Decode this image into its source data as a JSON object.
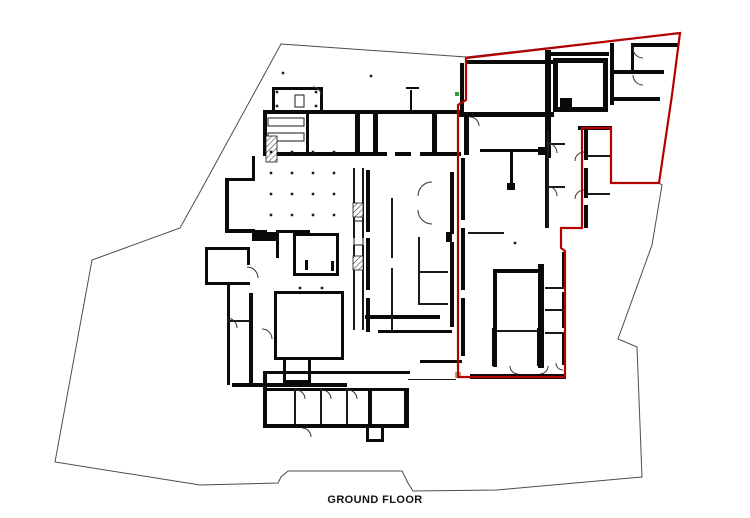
{
  "title": {
    "label": "GROUND FLOOR"
  },
  "palette": {
    "background": "#ffffff",
    "wall": "#0a0a0a",
    "thin_wall": "#1a1a1a",
    "demise_red": "#b40000",
    "site_boundary": "#4d4d4d",
    "door_arc": "#333333",
    "survey_green": "#2e9e3a",
    "survey_tan": "#b9a469"
  },
  "plan": {
    "site_boundary_points": "281,44 466,57 680,33 672,95 659,183 662,185 652,245 618,339 637,347 642,477 497,490 413,491 408,483 402,471 288,471 281,477 278,483 200,485 55,462 92,260 180,228 200,192",
    "demise_points": "466,58 680,33 672,95 659,183 611,183 611,128 582,128 582,228 561,228 561,248 565,251 565,377 458,377 458,105 466,100",
    "walls": [
      [
        272,
        87,
        51,
        3
      ],
      [
        272,
        87,
        3,
        25
      ],
      [
        320,
        87,
        3,
        25
      ],
      [
        263,
        110,
        198,
        4
      ],
      [
        263,
        110,
        4,
        46
      ],
      [
        306,
        110,
        3,
        46
      ],
      [
        355,
        110,
        5,
        46
      ],
      [
        373,
        110,
        5,
        46
      ],
      [
        432,
        112,
        5,
        42
      ],
      [
        464,
        112,
        5,
        43
      ],
      [
        263,
        152,
        124,
        4
      ],
      [
        395,
        152,
        16,
        4
      ],
      [
        420,
        152,
        41,
        4
      ],
      [
        406,
        87,
        13,
        2
      ],
      [
        410,
        90,
        2,
        20
      ],
      [
        225,
        178,
        30,
        3
      ],
      [
        225,
        178,
        4,
        54
      ],
      [
        225,
        229,
        30,
        3
      ],
      [
        252,
        156,
        3,
        24
      ],
      [
        225,
        230,
        42,
        3
      ],
      [
        276,
        230,
        34,
        3
      ],
      [
        252,
        232,
        26,
        9
      ],
      [
        276,
        230,
        3,
        28
      ],
      [
        293,
        233,
        46,
        3
      ],
      [
        293,
        233,
        3,
        43
      ],
      [
        293,
        273,
        46,
        3
      ],
      [
        336,
        233,
        3,
        43
      ],
      [
        305,
        260,
        3,
        10
      ],
      [
        331,
        261,
        3,
        10
      ],
      [
        205,
        247,
        45,
        3
      ],
      [
        205,
        247,
        3,
        38
      ],
      [
        205,
        282,
        45,
        3
      ],
      [
        247,
        247,
        3,
        18
      ],
      [
        227,
        283,
        3,
        102
      ],
      [
        249,
        293,
        4,
        92
      ],
      [
        232,
        383,
        115,
        4
      ],
      [
        274,
        291,
        70,
        3
      ],
      [
        274,
        291,
        3,
        69
      ],
      [
        274,
        357,
        70,
        3
      ],
      [
        341,
        291,
        3,
        69
      ],
      [
        283,
        357,
        3,
        26
      ],
      [
        283,
        380,
        28,
        3
      ],
      [
        308,
        357,
        3,
        26
      ],
      [
        366,
        170,
        4,
        62
      ],
      [
        366,
        238,
        4,
        52
      ],
      [
        366,
        298,
        4,
        34
      ],
      [
        450,
        172,
        4,
        62
      ],
      [
        450,
        242,
        4,
        85
      ],
      [
        461,
        158,
        4,
        62
      ],
      [
        461,
        228,
        4,
        62
      ],
      [
        461,
        298,
        4,
        58
      ],
      [
        446,
        232,
        6,
        10
      ],
      [
        365,
        315,
        75,
        4
      ],
      [
        378,
        330,
        74,
        3
      ],
      [
        420,
        360,
        42,
        3
      ],
      [
        263,
        371,
        4,
        57
      ],
      [
        263,
        371,
        147,
        3
      ],
      [
        263,
        424,
        112,
        4
      ],
      [
        267,
        388,
        142,
        3
      ],
      [
        368,
        388,
        4,
        40
      ],
      [
        404,
        388,
        5,
        40
      ],
      [
        368,
        424,
        41,
        4
      ],
      [
        366,
        428,
        3,
        13
      ],
      [
        381,
        428,
        3,
        13
      ],
      [
        366,
        439,
        18,
        3
      ],
      [
        465,
        60,
        88,
        4
      ],
      [
        545,
        50,
        6,
        108
      ],
      [
        551,
        52,
        58,
        4
      ],
      [
        553,
        58,
        55,
        5
      ],
      [
        553,
        58,
        5,
        54
      ],
      [
        553,
        107,
        55,
        5
      ],
      [
        603,
        58,
        5,
        54
      ],
      [
        560,
        98,
        12,
        10
      ],
      [
        458,
        112,
        96,
        5
      ],
      [
        460,
        63,
        4,
        49
      ],
      [
        480,
        149,
        66,
        3
      ],
      [
        538,
        147,
        9,
        8
      ],
      [
        510,
        152,
        3,
        35
      ],
      [
        507,
        183,
        8,
        7
      ],
      [
        610,
        43,
        4,
        62
      ],
      [
        631,
        43,
        48,
        4
      ],
      [
        612,
        70,
        52,
        4
      ],
      [
        612,
        97,
        48,
        4
      ],
      [
        631,
        45,
        3,
        26
      ],
      [
        578,
        126,
        34,
        4
      ],
      [
        584,
        130,
        4,
        30
      ],
      [
        584,
        168,
        4,
        30
      ],
      [
        584,
        205,
        4,
        23
      ],
      [
        545,
        128,
        4,
        100
      ],
      [
        538,
        264,
        6,
        104
      ],
      [
        562,
        252,
        4,
        35
      ],
      [
        562,
        292,
        4,
        36
      ],
      [
        562,
        332,
        4,
        33
      ],
      [
        495,
        269,
        46,
        4
      ],
      [
        493,
        269,
        4,
        98
      ],
      [
        492,
        328,
        5,
        38
      ],
      [
        537,
        328,
        6,
        38
      ],
      [
        470,
        374,
        96,
        5
      ]
    ],
    "thin_walls": [
      [
        353,
        168,
        2,
        70
      ],
      [
        353,
        245,
        2,
        85
      ],
      [
        362,
        168,
        2,
        70
      ],
      [
        362,
        245,
        2,
        85
      ],
      [
        391,
        198,
        2,
        60
      ],
      [
        391,
        268,
        2,
        62
      ],
      [
        418,
        237,
        2,
        68
      ],
      [
        418,
        271,
        30,
        2
      ],
      [
        418,
        303,
        30,
        2
      ],
      [
        294,
        388,
        2,
        36
      ],
      [
        320,
        388,
        2,
        36
      ],
      [
        346,
        388,
        2,
        36
      ],
      [
        227,
        320,
        24,
        2
      ],
      [
        547,
        130,
        2,
        98
      ],
      [
        547,
        143,
        18,
        2
      ],
      [
        547,
        186,
        18,
        2
      ],
      [
        586,
        155,
        24,
        2
      ],
      [
        586,
        193,
        24,
        2
      ],
      [
        545,
        287,
        20,
        2
      ],
      [
        545,
        309,
        20,
        2
      ],
      [
        545,
        332,
        20,
        2
      ],
      [
        497,
        330,
        40,
        2
      ],
      [
        468,
        232,
        36,
        2
      ],
      [
        408,
        379,
        48,
        1
      ]
    ],
    "boxes": [
      [
        295,
        95,
        9,
        12
      ],
      [
        268,
        118,
        36,
        8
      ],
      [
        268,
        133,
        36,
        8
      ],
      [
        354,
        221,
        9,
        24
      ]
    ],
    "hatches": [
      [
        266,
        136,
        11,
        26
      ],
      [
        353,
        203,
        10,
        14
      ],
      [
        353,
        256,
        10,
        14
      ]
    ],
    "dots": [
      [
        271,
        152
      ],
      [
        292,
        152
      ],
      [
        313,
        152
      ],
      [
        334,
        152
      ],
      [
        271,
        173
      ],
      [
        292,
        173
      ],
      [
        313,
        173
      ],
      [
        334,
        173
      ],
      [
        271,
        194
      ],
      [
        292,
        194
      ],
      [
        313,
        194
      ],
      [
        334,
        194
      ],
      [
        271,
        215
      ],
      [
        292,
        215
      ],
      [
        313,
        215
      ],
      [
        334,
        215
      ],
      [
        300,
        288
      ],
      [
        322,
        288
      ],
      [
        515,
        243
      ],
      [
        277,
        92
      ],
      [
        316,
        92
      ],
      [
        277,
        106
      ],
      [
        316,
        106
      ],
      [
        283,
        73
      ],
      [
        371,
        76
      ]
    ],
    "door_arcs": [
      "M313,87 A8,8 0 0 1 321,95",
      "M247,267 A11,11 0 0 1 258,278",
      "M227,318 A10,10 0 0 1 237,328",
      "M262,329 A10,10 0 0 1 272,339",
      "M296,390 A9,9 0 0 1 305,399",
      "M322,390 A9,9 0 0 1 331,399",
      "M348,390 A9,9 0 0 1 357,399",
      "M302,428 A9,9 0 0 1 311,437",
      "M432,182 A14,14 0 0 0 418,196",
      "M432,224 A14,14 0 0 1 418,210",
      "M547,143 A10,10 0 0 1 557,153",
      "M547,186 A10,10 0 0 1 557,196",
      "M584,152 A9,9 0 0 0 575,161",
      "M584,190 A9,9 0 0 0 575,199",
      "M633,48 A10,10 0 0 0 643,58",
      "M633,75 A10,10 0 0 0 643,85",
      "M518,374 A8,8 0 0 1 510,366",
      "M540,374 A8,8 0 0 0 548,366",
      "M563,370 A7,7 0 0 1 556,363",
      "M470,117 A9,9 0 0 1 479,126"
    ],
    "marks": [
      {
        "x": 455,
        "y": 92,
        "w": 4,
        "h": 4,
        "color": "#2e9e3a"
      },
      {
        "x": 455,
        "y": 372,
        "w": 6,
        "h": 6,
        "color": "#b9a469"
      }
    ]
  }
}
